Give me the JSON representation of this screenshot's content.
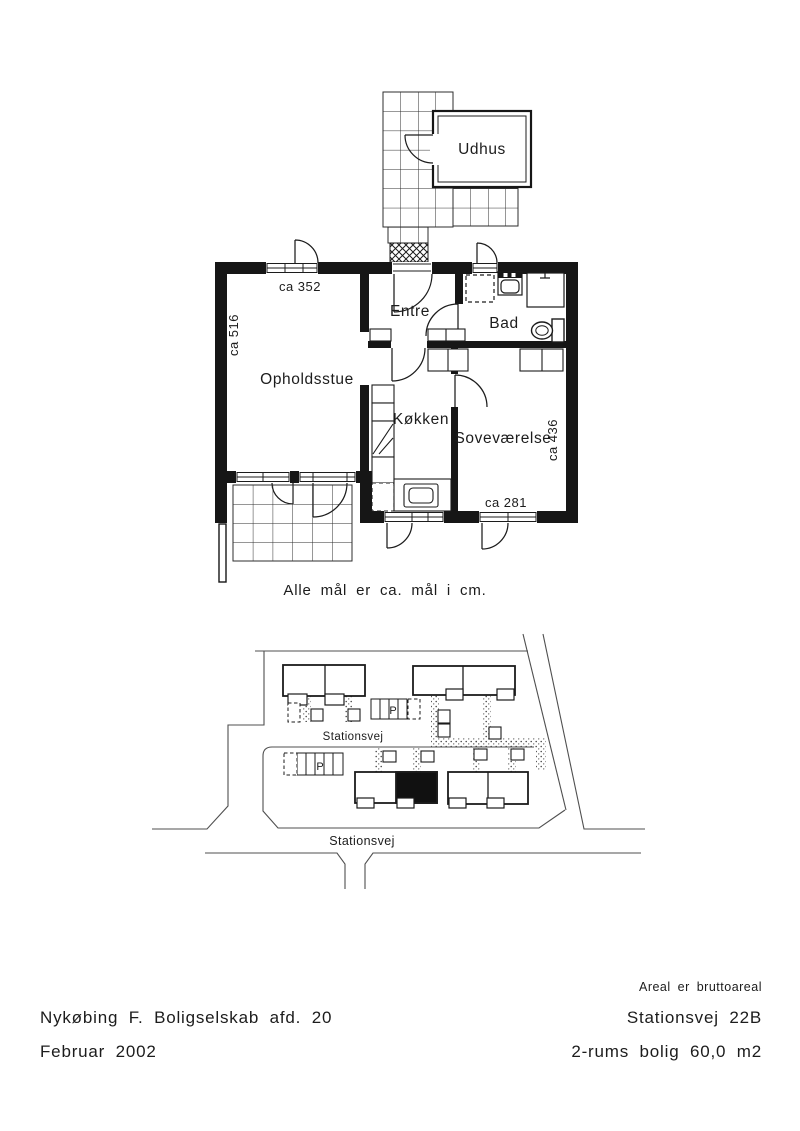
{
  "page": {
    "background": "#ffffff",
    "wall_color": "#161616",
    "line_color": "#2b2b2b",
    "road_color": "#4f4f4f"
  },
  "floor_plan": {
    "shed_label": "Udhus",
    "rooms": {
      "hall": "Entre",
      "bath": "Bad",
      "living": "Opholdsstue",
      "kitchen": "Køkken",
      "bedroom": "Soveværelse"
    },
    "dimensions": {
      "living_width": "ca 352",
      "living_depth": "ca 516",
      "bedroom_depth": "ca 436",
      "bedroom_width": "ca 281"
    },
    "note": "Alle mål er ca. mål i cm."
  },
  "site_plan": {
    "street_top": "Stationsvej",
    "street_bottom": "Stationsvej",
    "parking_top": "P",
    "parking_bottom": "P"
  },
  "footer": {
    "org": "Nykøbing F. Boligselskab afd. 20",
    "date": "Februar 2002",
    "area_note": "Areal er bruttoareal",
    "address": "Stationsvej 22B",
    "dwelling": "2-rums bolig 60,0 m2"
  }
}
